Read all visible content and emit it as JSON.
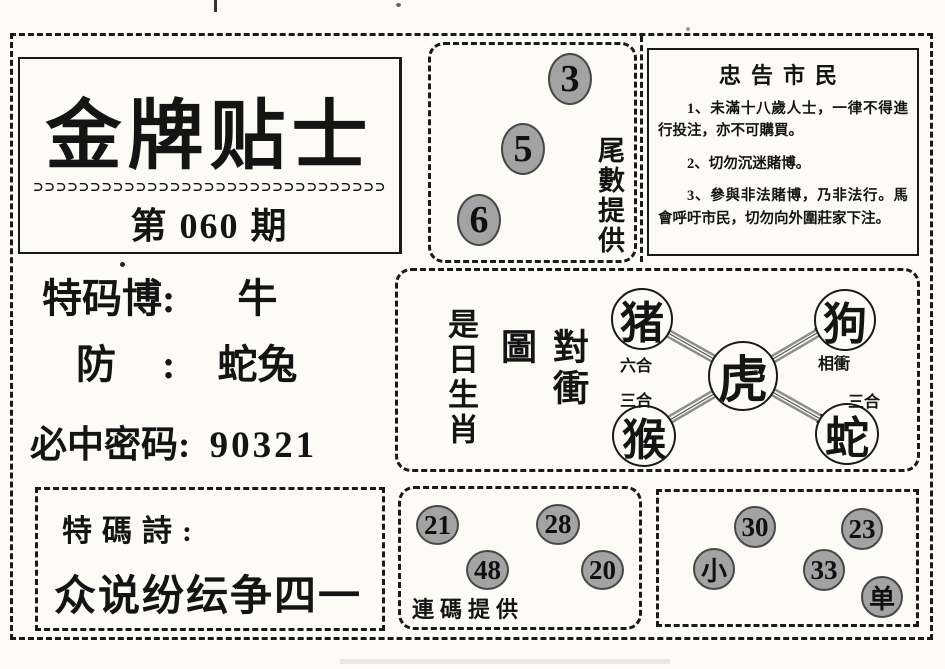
{
  "colors": {
    "paper": "#fcfbf6",
    "ink": "#141414",
    "circle_gray": "#a3a3a3",
    "arrow_rail": "#8d8d8d"
  },
  "header": {
    "title": "金牌贴士",
    "decoration": "⊃⊃⊃⊃⊃⊃⊃⊃⊃⊃⊃⊃⊃⊃⊃⊃⊃⊃⊃⊃⊃⊃⊃⊃⊃⊃⊃⊃⊃⊃⊃",
    "issue": "第 060 期"
  },
  "predictions": {
    "special_label": "特码博:",
    "special_value": "牛",
    "guard_label": "防 :",
    "guard_value": "蛇兔",
    "code_label": "必中密码:",
    "code_value": "90321"
  },
  "tail_numbers": {
    "label": "尾數提供",
    "values": [
      "3",
      "5",
      "6"
    ]
  },
  "advice": {
    "title": "忠告市民",
    "items": [
      "1、未滿十八歲人士，一律不得進行投注，亦不可購買。",
      "2、切勿沉迷賭博。",
      "3、參與非法賭博，乃非法行。馬會呼吁市民，切勿向外圍莊家下注。"
    ]
  },
  "zodiac_chart": {
    "side_label": "是日生肖",
    "title": "對衝圖",
    "center": "虎",
    "corners": [
      {
        "name": "猪",
        "relation": "六合"
      },
      {
        "name": "狗",
        "relation": "相衝"
      },
      {
        "name": "猴",
        "relation": "三合"
      },
      {
        "name": "蛇",
        "relation": "三合"
      }
    ]
  },
  "poem": {
    "label": "特碼詩:",
    "line": "众说纷纭争四一"
  },
  "pair_numbers": {
    "label": "連碼提供",
    "values": [
      "21",
      "28",
      "48",
      "20"
    ]
  },
  "extra_tips": {
    "values": [
      "30",
      "23",
      "小",
      "33",
      "单"
    ]
  }
}
